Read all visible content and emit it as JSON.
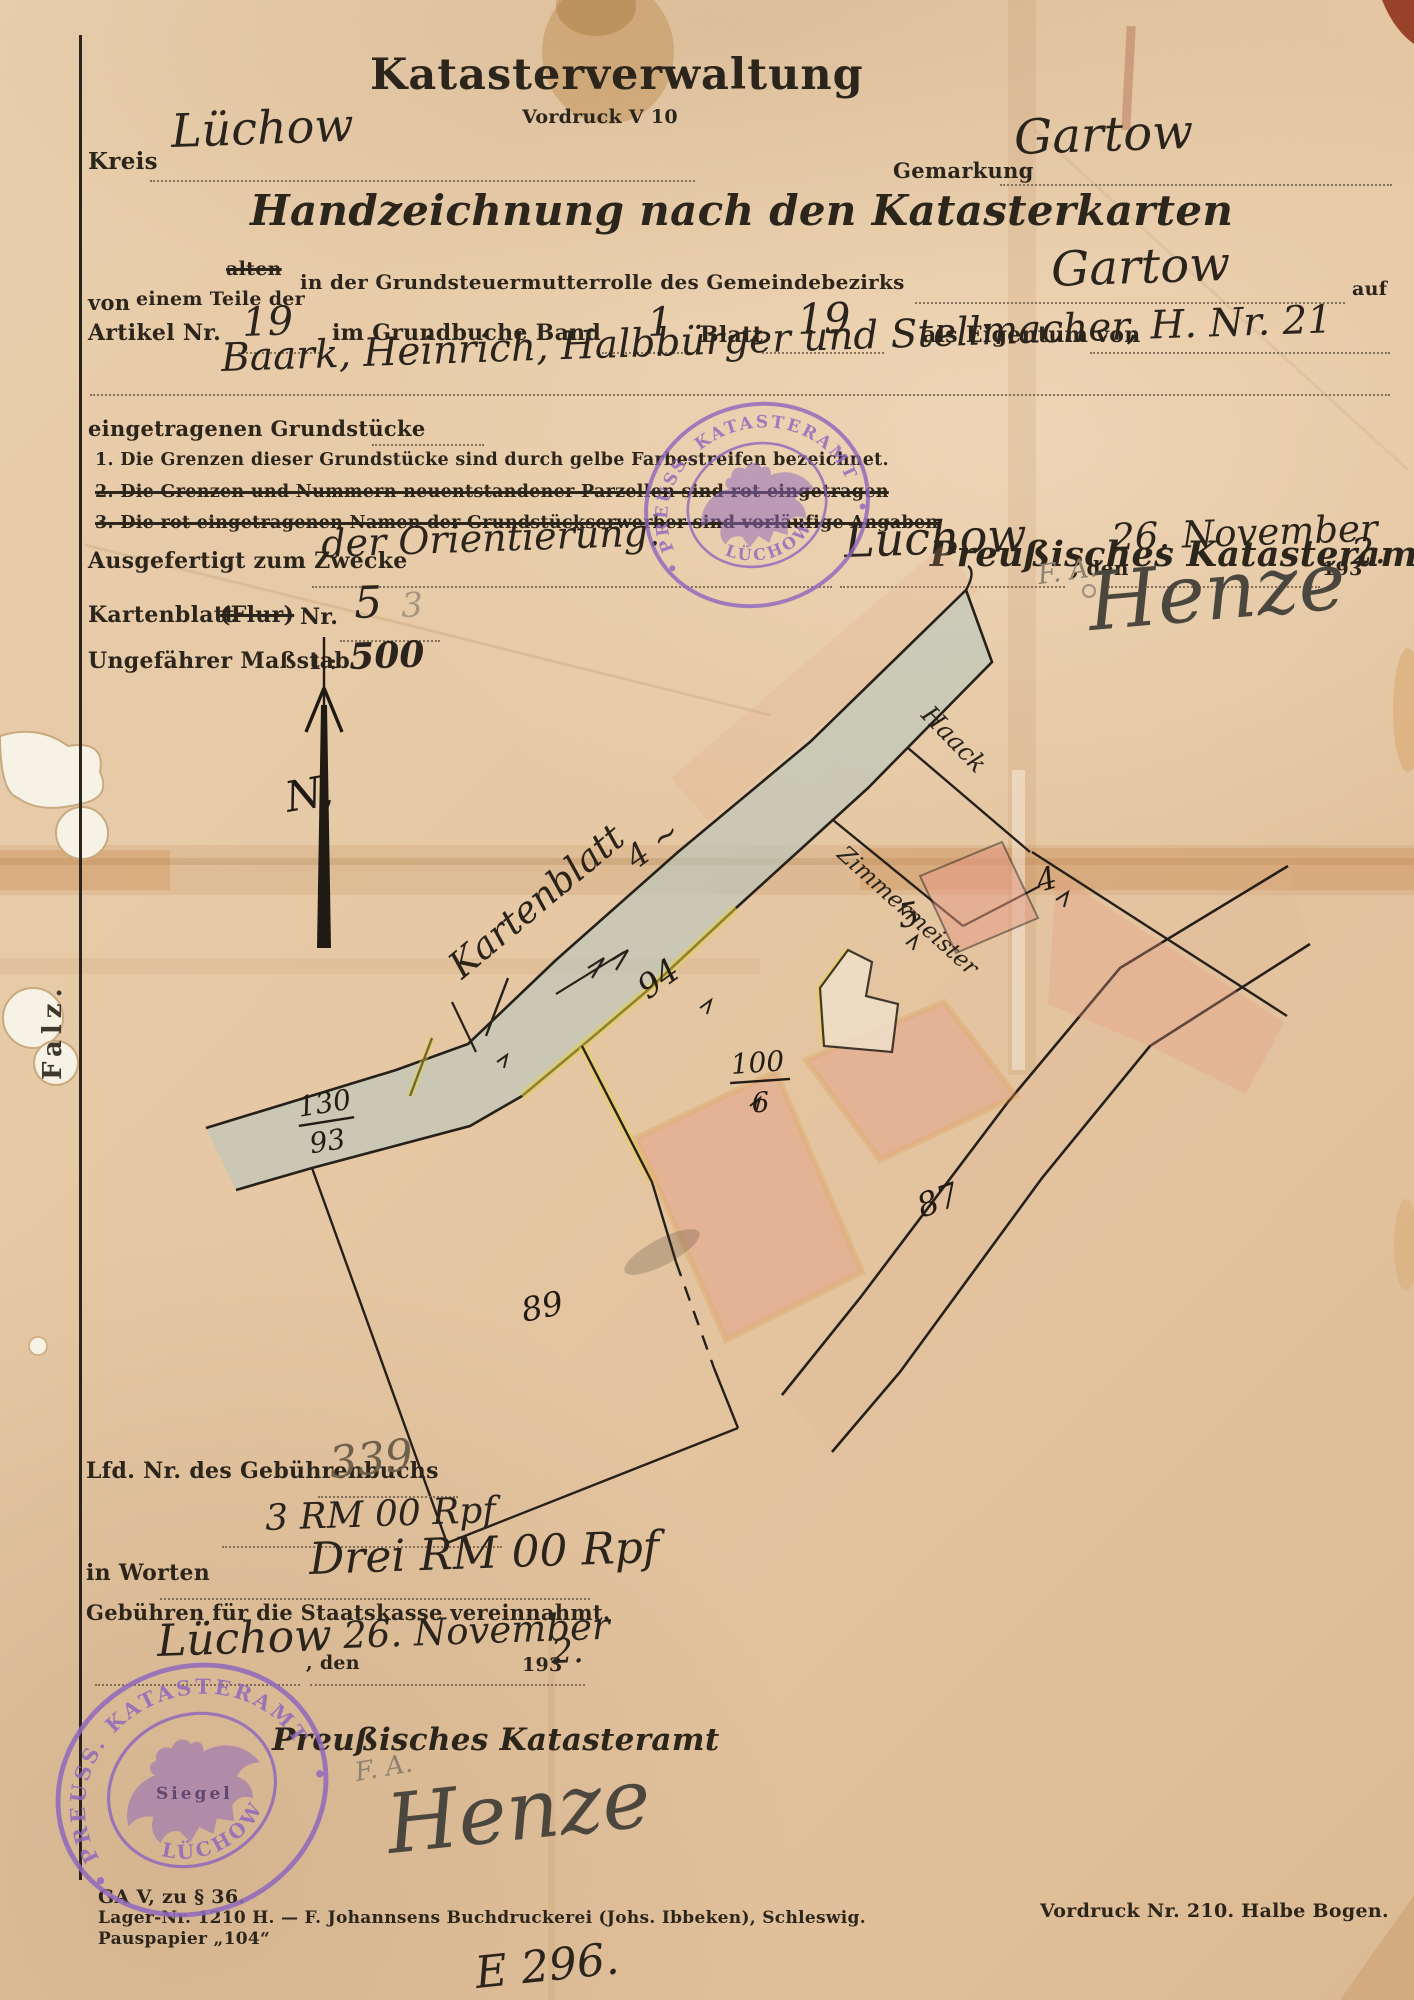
{
  "header": {
    "title": "Katasterverwaltung",
    "form_code": "Vordruck V 10",
    "kreis_label": "Kreis",
    "kreis_value": "Lüchow",
    "gemarkung_label": "Gemarkung",
    "gemarkung_value": "Gartow",
    "subtitle": "Handzeichnung nach den Katasterkarten"
  },
  "intro": {
    "von_label": "von",
    "alten_struck": "alten",
    "teile_label": "einem Teile der",
    "rolle_label": "in der Grundsteuermutterrolle des Gemeindebezirks",
    "bezirk_value": "Gartow",
    "auf_label": "auf",
    "artikel_label": "Artikel Nr.",
    "artikel_value": "19",
    "grundbuch_label": "im Grundbuche Band",
    "band_value": "1",
    "blatt_label": "Blatt",
    "blatt_value": "19",
    "eigentum_label": "als Eigentum von",
    "owner_value": "Baark, Heinrich, Halbbürger und Stellmacher, H. Nr. 21",
    "grundstuecke_label": "eingetragenen Grundstücke",
    "note1": "1. Die Grenzen dieser Grundstücke sind durch gelbe Farbestreifen bezeichnet.",
    "note2": "2. Die Grenzen und Nummern neuentstandener Parzellen sind rot eingetragen",
    "note3": "3. Die rot eingetragenen Namen der Grundstückserwerber sind vorläufige Angaben"
  },
  "issue": {
    "ausgefertigt_label": "Ausgefertigt zum Zwecke",
    "zweck_value": "der Orientierung.",
    "ort_value": "Lüchow",
    "den_label": ", den",
    "date_value": "26. November",
    "year_printed": "193",
    "year_written": "2.",
    "kartenblatt_label": "Kartenblatt",
    "flur_struck": "(Flur)",
    "nr_label": "Nr.",
    "kartenblatt_value": "5",
    "kartenblatt_pencil": "3",
    "massstab_label": "Ungefährer Maßstab",
    "massstab_prefix": "1 :",
    "massstab_value": "500",
    "amt_label": "Preußisches Katasteramt",
    "signature_initials": "F. A.",
    "signature_name": "Henze"
  },
  "stamp": {
    "ring_text": "PREUSS. KATASTERAMT",
    "city_text": "LÜCHOW",
    "siegel_label": "Siegel",
    "ink_color": "#9068bd"
  },
  "map": {
    "north_label": "N,",
    "kartenblatt_annotation": "Kartenblatt",
    "kartenblatt_number": "4 ~",
    "road_number": "94",
    "parcel_130": "130",
    "parcel_93": "93",
    "parcel_100": "100",
    "parcel_6": "6",
    "parcel_5": "5",
    "parcel_4": "4",
    "parcel_87": "87",
    "parcel_89": "89",
    "handwriting_1": "Haack",
    "handwriting_2": "Zimmermeister",
    "colors": {
      "road_blue": "#b7c8c0",
      "parcel_pink": "#e59a86",
      "edge_orange": "#d89140",
      "stripe_yellow": "#e6d24c",
      "ink": "#26201a"
    }
  },
  "fees": {
    "lfd_label": "Lfd. Nr. des Gebührenbuchs",
    "lfd_value": "339",
    "amount_value": "3 RM 00 Rpf",
    "worten_label": "in Worten",
    "worten_value": "Drei RM 00 Rpf",
    "staatskasse_label": "Gebühren für die Staatskasse vereinnahmt.",
    "ort_value": "Lüchow",
    "den_label": ", den",
    "date_value": "26. November",
    "year_printed": "193",
    "year_written": "2.",
    "amt_label": "Preußisches Katasteramt",
    "signature_initials": "F. A.",
    "signature_name": "Henze"
  },
  "footer": {
    "left_line1": "GA V, zu § 36.",
    "left_line2": "Lager-Nr. 1210 H. — F. Johannsens Buchdruckerei (Johs. Ibbeken), Schleswig.",
    "left_line3": "Pauspapier „104“",
    "right_text": "Vordruck Nr. 210.   Halbe Bogen.",
    "ledger_note": "E 296.",
    "falz_label": "Falz."
  }
}
